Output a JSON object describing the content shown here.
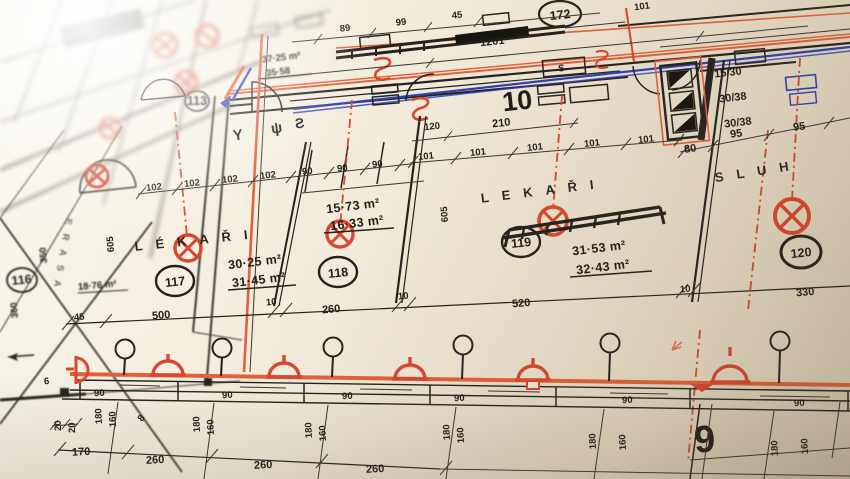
{
  "grid": {
    "axis_top": "10",
    "axis_bottom": "9"
  },
  "tags": {
    "t113": "113",
    "t116": "116",
    "t117": "117",
    "t118": "118",
    "t119": "119",
    "t120": "120",
    "t172": "172"
  },
  "labels": {
    "lekari_left": "LÉKAŘI",
    "lekari_right": "LEKAŘI",
    "sluh": "SLUH",
    "terasa": "ERASA",
    "s_box": "S"
  },
  "areas": {
    "upper1": "37·25 m²",
    "upper2": "35·58",
    "r116": "18·76 m²",
    "r117a": "30·25 m²",
    "r117b": "31·45 m²",
    "r118a": "15·73 m²",
    "r118b": "16·33 m²",
    "r119a": "31·53 m²",
    "r119b": "32·43 m²"
  },
  "legend": {
    "row1": "15/30",
    "row2": "30/38",
    "row3": "30/38"
  },
  "dims": {
    "d6": "6",
    "d8": "8",
    "d10": "10",
    "d20": "20",
    "d45": "45",
    "d80": "80",
    "d89": "89",
    "d90": "90",
    "d95": "95",
    "d99": "99",
    "d101": "101",
    "d102": "102",
    "d120": "120",
    "d160": "160",
    "d170": "170",
    "d180": "180",
    "d210": "210",
    "d260": "260",
    "d330": "330",
    "d350": "350",
    "d360": "360",
    "d500": "500",
    "d520": "520",
    "d605": "605",
    "d1201": "1201"
  }
}
